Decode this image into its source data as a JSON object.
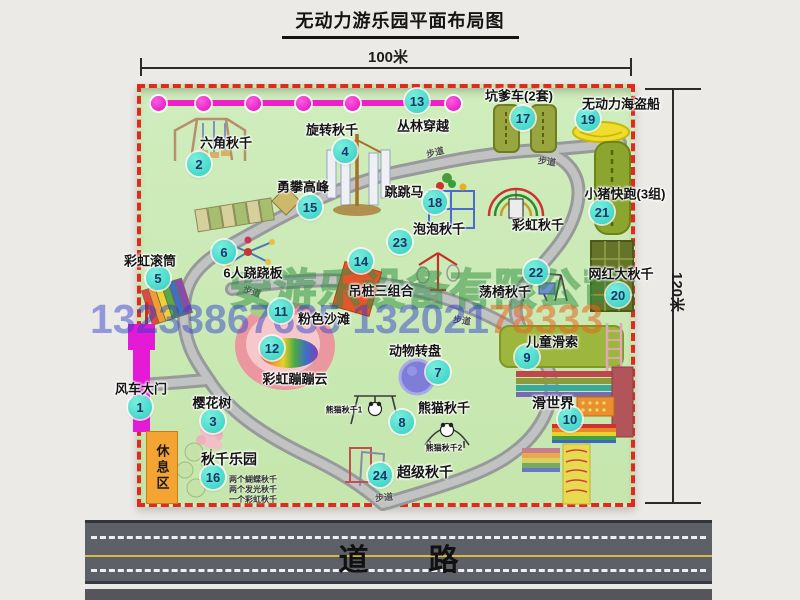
{
  "title": "无动力游乐园平面布局图",
  "dims": {
    "width_label": "100米",
    "height_label": "120米"
  },
  "road": {
    "label": "道　　路"
  },
  "watermark": {
    "company": "安游乐设备有限公司",
    "phone_main": "13233867635 132021",
    "phone_tail": "78333"
  },
  "rest_area_label": "休息区",
  "colors": {
    "park_green": "#cde9b8",
    "border_red": "#e02a1e",
    "marker_teal": "#3ed6c8",
    "gate_magenta": "#e51ad6",
    "jungle_magenta": "#ee1ec9",
    "rest_orange": "#f4a433",
    "road_gray": "#5e6068"
  },
  "attractions": [
    {
      "num": "1",
      "label": "风车大门",
      "cx": 140,
      "cy": 407,
      "lx": 141,
      "ly": 388
    },
    {
      "num": "2",
      "label": "六角秋千",
      "cx": 199,
      "cy": 164,
      "lx": 226,
      "ly": 142
    },
    {
      "num": "3",
      "label": "樱花树",
      "cx": 213,
      "cy": 421,
      "lx": 212,
      "ly": 402
    },
    {
      "num": "4",
      "label": "旋转秋千",
      "cx": 345,
      "cy": 151,
      "lx": 332,
      "ly": 129
    },
    {
      "num": "5",
      "label": "彩虹滚筒",
      "cx": 158,
      "cy": 278,
      "lx": 150,
      "ly": 260
    },
    {
      "num": "6",
      "label": "6人跷跷板",
      "cx": 224,
      "cy": 252,
      "lx": 253,
      "ly": 272
    },
    {
      "num": "7",
      "label": "动物转盘",
      "cx": 438,
      "cy": 372,
      "lx": 415,
      "ly": 350
    },
    {
      "num": "8",
      "label": "熊猫秋千",
      "cx": 402,
      "cy": 422,
      "lx": 444,
      "ly": 407
    },
    {
      "num": "9",
      "label": "儿童滑索",
      "cx": 527,
      "cy": 357,
      "lx": 552,
      "ly": 341
    },
    {
      "num": "10",
      "label": "滑世界",
      "s": 14,
      "cx": 570,
      "cy": 419,
      "lx": 553,
      "ly": 403
    },
    {
      "num": "11",
      "label": "粉色沙滩",
      "cx": 281,
      "cy": 311,
      "lx": 324,
      "ly": 318
    },
    {
      "num": "12",
      "label": "彩虹蹦蹦云",
      "cx": 272,
      "cy": 348,
      "lx": 295,
      "ly": 378
    },
    {
      "num": "13",
      "label": "丛林穿越",
      "cx": 417,
      "cy": 101,
      "lx": 423,
      "ly": 125
    },
    {
      "num": "14",
      "label": "吊桩三组合",
      "cx": 361,
      "cy": 261,
      "lx": 381,
      "ly": 290
    },
    {
      "num": "15",
      "label": "勇攀高峰",
      "cx": 310,
      "cy": 207,
      "lx": 303,
      "ly": 186
    },
    {
      "num": "16",
      "label": "秋千乐园",
      "s": 14,
      "cx": 213,
      "cy": 477,
      "lx": 229,
      "ly": 459
    },
    {
      "num": "17",
      "label": "坑爹车(2套)",
      "cx": 523,
      "cy": 118,
      "lx": 519,
      "ly": 95
    },
    {
      "num": "18",
      "label": "跳跳马",
      "cx": 435,
      "cy": 202,
      "lx": 404,
      "ly": 191
    },
    {
      "num": "19",
      "label": "无动力海盗船",
      "cx": 588,
      "cy": 119,
      "lx": 621,
      "ly": 103
    },
    {
      "num": "20",
      "label": "网红大秋千",
      "cx": 618,
      "cy": 295,
      "lx": 621,
      "ly": 273
    },
    {
      "num": "21",
      "label": "小猪快跑(3组)",
      "cx": 602,
      "cy": 212,
      "lx": 625,
      "ly": 193
    },
    {
      "num": "22",
      "label": "荡椅秋千",
      "cx": 536,
      "cy": 272,
      "lx": 505,
      "ly": 291
    },
    {
      "num": "23",
      "label": "泡泡秋千",
      "cx": 400,
      "cy": 242,
      "lx": 439,
      "ly": 228
    },
    {
      "num": "24",
      "label": "超级秋千",
      "s": 14,
      "cx": 380,
      "cy": 475,
      "lx": 425,
      "ly": 472
    }
  ],
  "extra_labels": [
    {
      "text": "彩虹秋千",
      "x": 538,
      "y": 224,
      "size": 13
    },
    {
      "text": "熊猫秋千1",
      "x": 344,
      "y": 410,
      "size": 8
    },
    {
      "text": "熊猫秋千2",
      "x": 444,
      "y": 448,
      "size": 8
    }
  ],
  "swing_notes": {
    "x": 229,
    "y": 474,
    "lines": [
      "两个蝴蝶秋千",
      "两个发光秋千",
      "一个彩虹秋千"
    ]
  },
  "path_labels": [
    {
      "text": "步道",
      "x": 435,
      "y": 152,
      "rot": -14
    },
    {
      "text": "步道",
      "x": 547,
      "y": 161,
      "rot": 8
    },
    {
      "text": "步道",
      "x": 252,
      "y": 291,
      "rot": 18
    },
    {
      "text": "步道",
      "x": 462,
      "y": 320,
      "rot": 8
    },
    {
      "text": "步道",
      "x": 384,
      "y": 497,
      "rot": -6
    }
  ],
  "jungle": {
    "y": 103,
    "balls_x": [
      158,
      203,
      253,
      303,
      352,
      453
    ]
  }
}
